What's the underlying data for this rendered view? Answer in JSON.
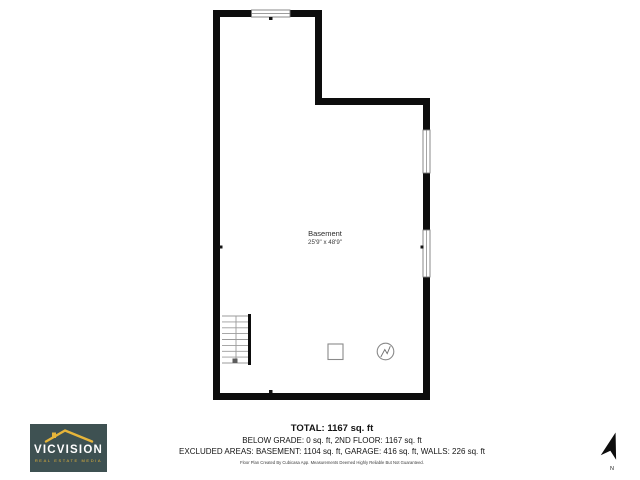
{
  "plan": {
    "room_name": "Basement",
    "room_dimensions": "25'9\" x 48'9\"",
    "wall_color": "#0d0d0d",
    "window_outline_color": "#7d7d7d",
    "fixtures": [
      "stairs",
      "square-fixture",
      "water-heater-circle"
    ],
    "window_count": 3
  },
  "summary": {
    "total": "TOTAL: 1167 sq. ft",
    "grade_line": "BELOW GRADE: 0 sq. ft, 2ND FLOOR: 1167 sq. ft",
    "excluded_line": "EXCLUDED AREAS: BASEMENT: 1104 sq. ft, GARAGE: 416 sq. ft, WALLS: 226 sq. ft",
    "disclaimer": "Floor Plan Created By Cubicasa App. Measurements Deemed Highly Reliable But Not Guaranteed."
  },
  "logo": {
    "name": "VICVISION",
    "tagline": "REAL ESTATE MEDIA",
    "background_color": "#3e5152",
    "accent_color": "#e6b53a",
    "text_color": "#ffffff"
  },
  "north": {
    "label": "N"
  }
}
